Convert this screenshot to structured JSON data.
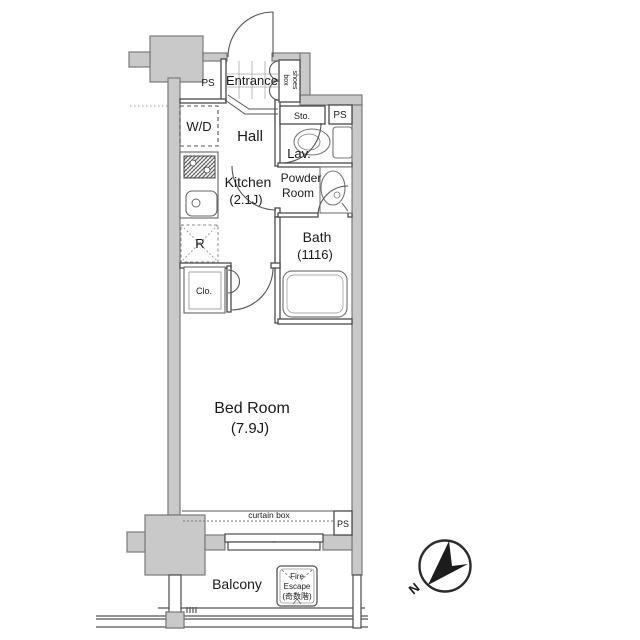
{
  "colors": {
    "background": "#ffffff",
    "wall_fill": "#c9c9c9",
    "wall_stroke": "#7a7a7a",
    "interior_line": "#4a4a4a",
    "fixture_line": "#777777",
    "text": "#1a1a1a",
    "compass_needle": "#1c1c1c"
  },
  "rooms": {
    "entrance": {
      "label": "Entrance"
    },
    "hall": {
      "label": "Hall"
    },
    "kitchen": {
      "label": "Kitchen",
      "size": "(2.1J)"
    },
    "lavatory": {
      "label": "Lav."
    },
    "powder_room": {
      "label_line1": "Powder",
      "label_line2": "Room"
    },
    "bath": {
      "label": "Bath",
      "size": "(1116)"
    },
    "bedroom": {
      "label": "Bed Room",
      "size": "(7.9J)"
    },
    "balcony": {
      "label": "Balcony"
    }
  },
  "features": {
    "shoes_box": {
      "line1": "shoes",
      "line2": "box"
    },
    "washer_dryer": {
      "label": "W/D"
    },
    "storage": {
      "label": "Sto."
    },
    "refrigerator": {
      "label": "R"
    },
    "closet": {
      "label": "Clo."
    },
    "curtain_box": {
      "label": "curtain box"
    },
    "fire_escape": {
      "line1": "Fire",
      "line2": "Escape",
      "line3": "(奇数階)"
    }
  },
  "pipe_shafts": {
    "top_left": "PS",
    "upper_right": "PS",
    "bottom_right": "PS"
  },
  "compass": {
    "north": "N"
  }
}
